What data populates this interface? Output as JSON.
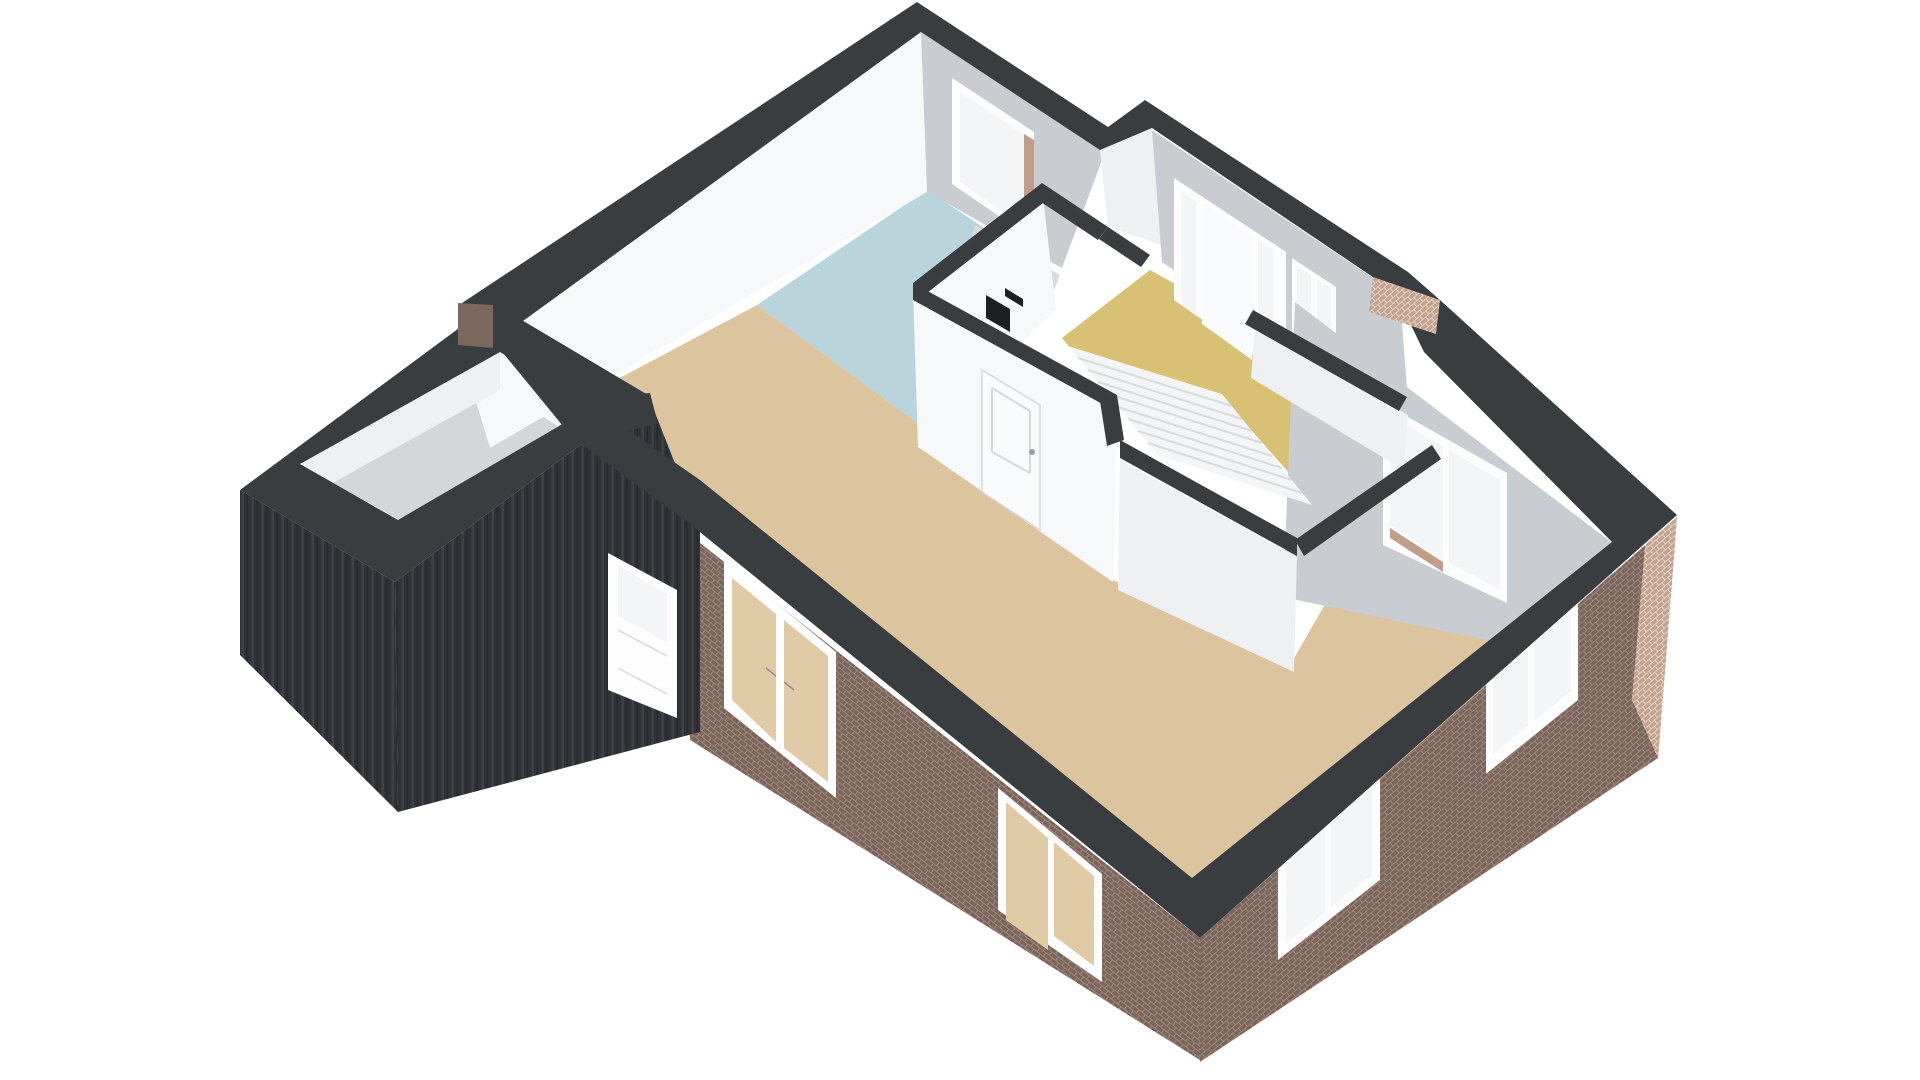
{
  "scene": {
    "type": "3d-floorplan-render",
    "view": "isometric-birdseye-cutaway",
    "background": "#ffffff"
  },
  "palette": {
    "band": "#3a3d40",
    "bandDark": "#33363a",
    "wallBright": "#f7f8fa",
    "wallWhite": "#eef0f2",
    "wallGray": "#c9cdd1",
    "wallGrayLight": "#d9dcdf",
    "floorBeige": "#dcc49e",
    "floorBlue": "#bad4dc",
    "floorYellow": "#d8c175",
    "floorGarage": "#d5d6d8",
    "brickShadowBrick": "#7b6459",
    "brickShadowMortar": "#9c8a7f",
    "brickLitBrick": "#c5a28e",
    "brickLitMortar": "#e3d5ca",
    "brickReveal": "#bf9e8a",
    "brickFlat": "#7c675c",
    "siding": "#2f3236",
    "sidingRib": "#3e4246",
    "sidingRibDark": "#24272a",
    "frameWhite": "#fdfdfe",
    "glass": "#f3f5f6",
    "glassTint": "#e0cba6",
    "stairField": "#f4f5f6",
    "treadLine": "#d8dbde",
    "doorWhite": "#fafbfc",
    "doorLine": "#d5d9dc",
    "black": "#1d1f21"
  },
  "features": {
    "floors": [
      "living-dining-beige",
      "kitchen-blue",
      "entrance-hall-yellow",
      "garage-gray"
    ],
    "windows": 7,
    "exterior_doors": 3,
    "interior_doors": 2,
    "has_staircase": true,
    "has_toilet": true
  }
}
